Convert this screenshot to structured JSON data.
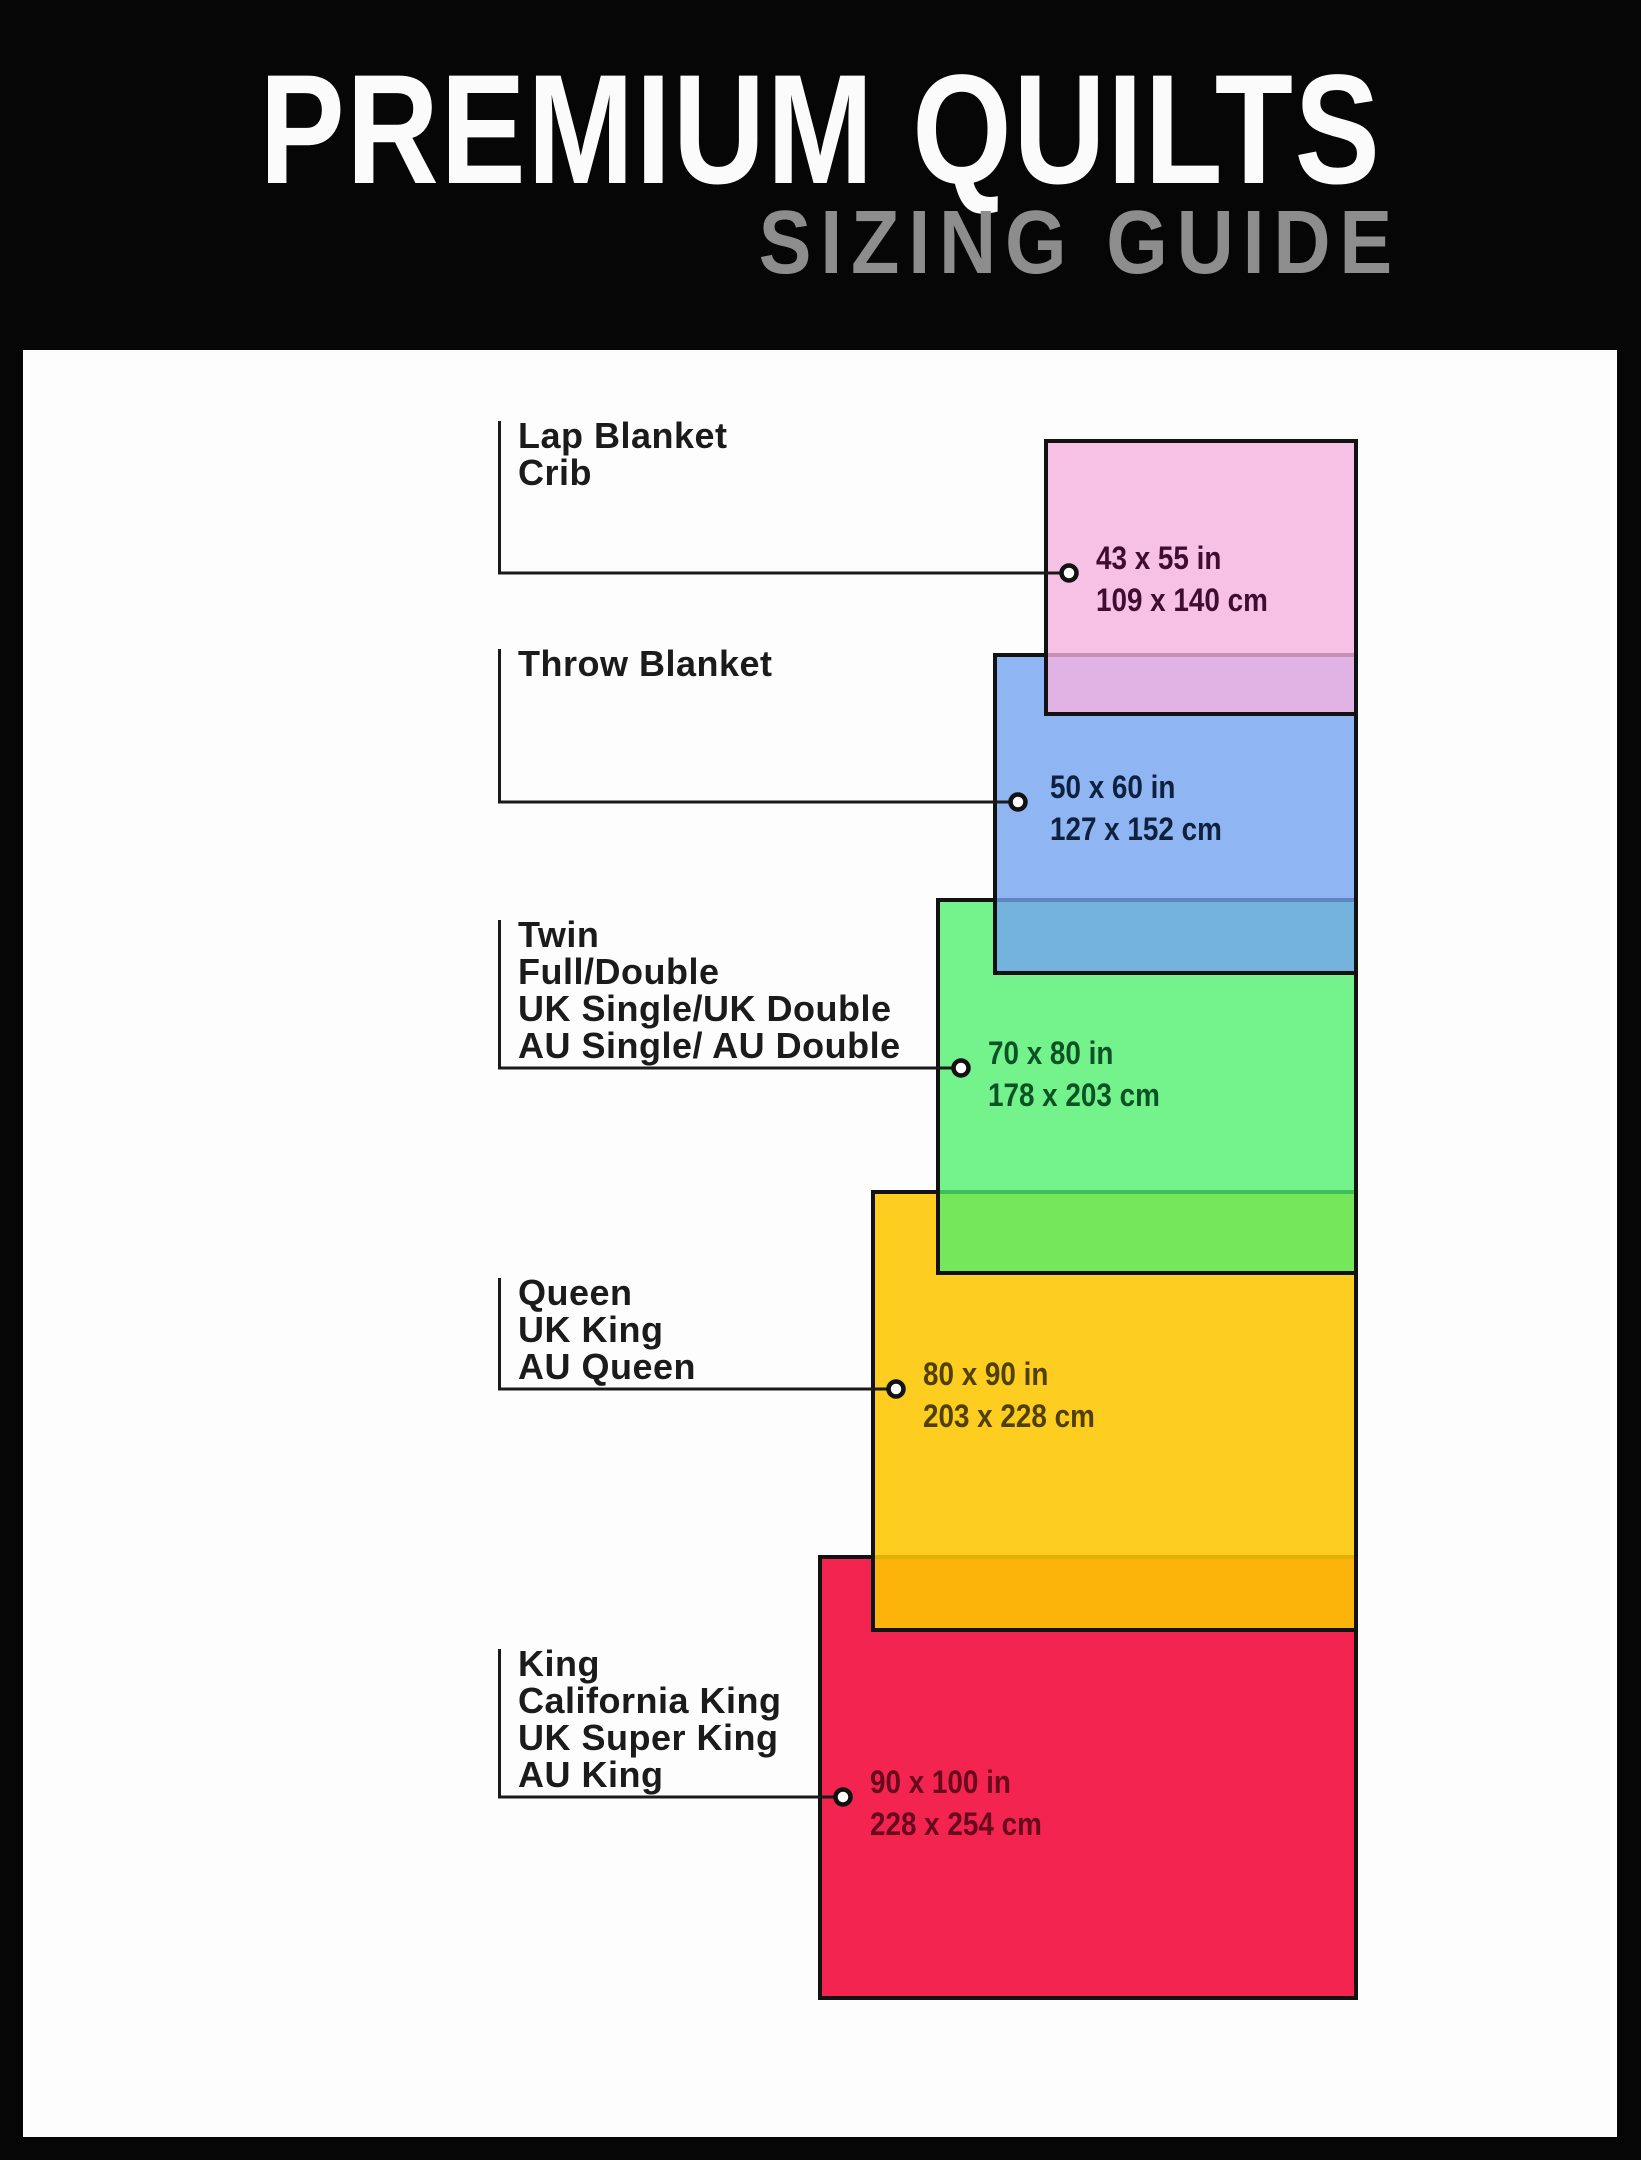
{
  "header": {
    "title": "PREMIUM QUILTS",
    "subtitle": "SIZING GUIDE",
    "bg_color": "#060606",
    "title_color": "#fbfbfb",
    "subtitle_color": "#8d8d8d"
  },
  "canvas": {
    "bg_color": "#fdfdfd",
    "frame_color": "#060606",
    "connector_color": "#1a1a1a",
    "connector_dot_fill": "#ffffff"
  },
  "sizes": [
    {
      "id": "lap-blanket-crib",
      "labels": [
        "Lap Blanket",
        "Crib"
      ],
      "size_in": "43 x 55 in",
      "size_cm": "109 x 140 cm",
      "fill_rgba": "rgba(245,178,224,0.80)",
      "text_color": "#3f0d31",
      "border_color": "#121212"
    },
    {
      "id": "throw-blanket",
      "labels": [
        "Throw Blanket"
      ],
      "size_in": "50 x 60 in",
      "size_cm": "127 x 152 cm",
      "fill_rgba": "rgba(116,163,240,0.80)",
      "text_color": "#0e2240",
      "border_color": "#121212"
    },
    {
      "id": "twin-full-double",
      "labels": [
        "Twin",
        "Full/Double",
        "UK Single/UK Double",
        "AU Single/ AU Double"
      ],
      "size_in": "70 x 80 in",
      "size_cm": "178 x 203 cm",
      "fill_rgba": "rgba(77,238,108,0.78)",
      "text_color": "#0d5226",
      "border_color": "#121212"
    },
    {
      "id": "queen-uk-king-au-queen",
      "labels": [
        "Queen",
        "UK King",
        "AU Queen"
      ],
      "size_in": "80 x 90 in",
      "size_cm": "203 x 228 cm",
      "fill_rgba": "rgba(253,199,0,0.88)",
      "text_color": "#514005",
      "border_color": "#121212"
    },
    {
      "id": "king-california-king",
      "labels": [
        "King",
        "California King",
        "UK Super King",
        "AU King"
      ],
      "size_in": "90 x 100 in",
      "size_cm": "228 x 254 cm",
      "fill_rgba": "rgba(242,12,61,0.90)",
      "text_color": "#670a1c",
      "border_color": "#121212"
    }
  ]
}
